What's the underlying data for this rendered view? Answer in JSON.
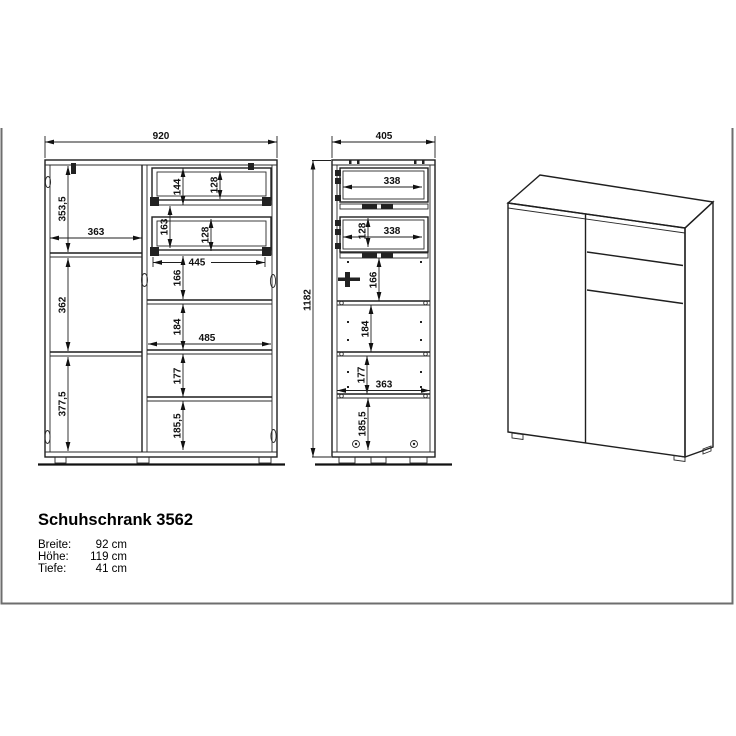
{
  "title_block": {
    "title": "Schuhschrank 3562",
    "specs": [
      {
        "label": "Breite:",
        "value": "92 cm"
      },
      {
        "label": "Höhe:",
        "value": "119 cm"
      },
      {
        "label": "Tiefe:",
        "value": "41 cm"
      }
    ]
  },
  "front_view": {
    "overall_width": "920",
    "left_height_top": "353,5",
    "left_width": "363",
    "left_height_mid": "362",
    "left_height_bottom": "377,5",
    "drawer1_height": "144",
    "drawer1_inner": "128",
    "drawer2_height": "163",
    "drawer2_inner": "128",
    "drawers_width": "445",
    "below_drawers_gap": "166",
    "shelf_gap_1": "184",
    "right_width": "485",
    "shelf_gap_2": "177",
    "shelf_gap_3": "185,5"
  },
  "side_view": {
    "overall_depth": "405",
    "overall_height": "1182",
    "drawer1_depth": "338",
    "drawer2_inner": "128",
    "drawer2_depth": "338",
    "below_drawers_gap": "166",
    "shelf_gap_1": "184",
    "shelf_gap_2": "177",
    "inner_depth": "363",
    "shelf_gap_3": "185,5"
  }
}
